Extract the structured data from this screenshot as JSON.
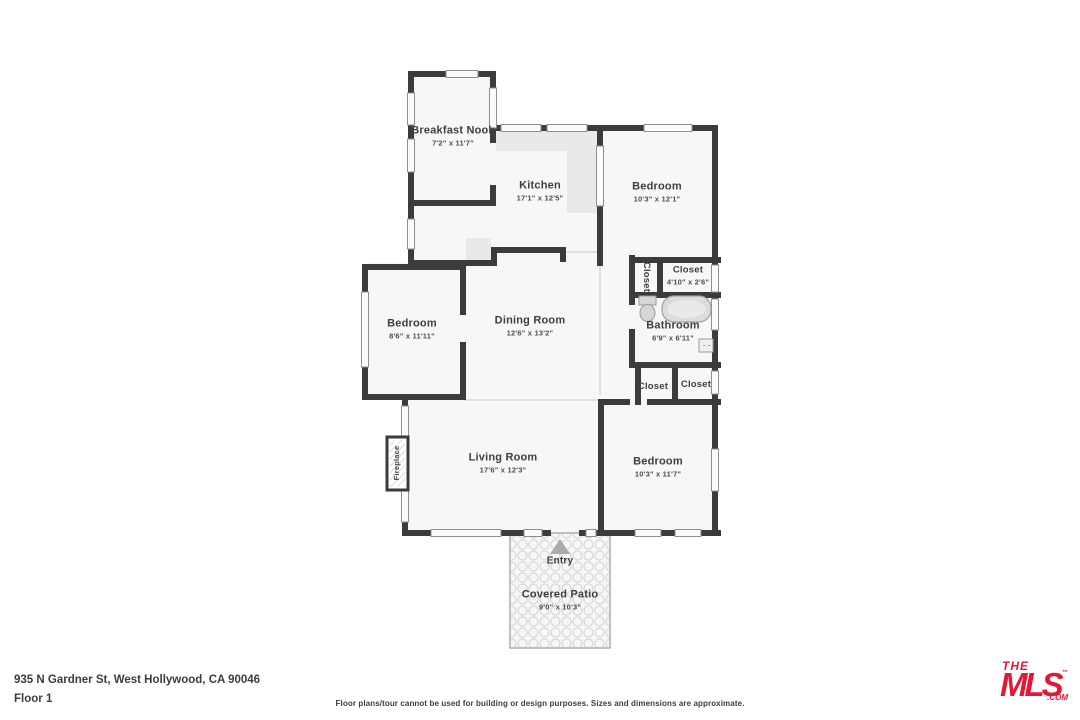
{
  "colors": {
    "wall": "#3b3b3b",
    "floor": "#f7f7f7",
    "counter": "#e9e9e9",
    "fixture": "#d9d9d9",
    "window_frame": "#8f8f8f",
    "patio_tile": "#d8d8d8",
    "logo_red": "#e31837",
    "text": "#3e3e3e"
  },
  "rooms": {
    "breakfast_nook": {
      "name": "Breakfast Nook",
      "dims": "7'2\" x 11'7\""
    },
    "kitchen": {
      "name": "Kitchen",
      "dims": "17'1\" x 12'5\""
    },
    "bedroom_tr": {
      "name": "Bedroom",
      "dims": "10'3\" x 12'1\""
    },
    "closet_hall": {
      "name": "Closet"
    },
    "closet_tr": {
      "name": "Closet",
      "dims": "4'10\" x 2'6\""
    },
    "bathroom": {
      "name": "Bathroom",
      "dims": "6'9\" x 6'11\""
    },
    "dining_room": {
      "name": "Dining Room",
      "dims": "12'6\" x 13'2\""
    },
    "bedroom_left": {
      "name": "Bedroom",
      "dims": "8'6\" x 11'11\""
    },
    "closet_bl": {
      "name": "Closet"
    },
    "closet_br": {
      "name": "Closet"
    },
    "living_room": {
      "name": "Living Room",
      "dims": "17'6\" x 12'3\""
    },
    "bedroom_br": {
      "name": "Bedroom",
      "dims": "10'3\" x 11'7\""
    },
    "covered_patio": {
      "name": "Covered Patio",
      "dims": "9'0\" x 10'3\""
    }
  },
  "labels": {
    "entry": "Entry",
    "fireplace": "Fireplace"
  },
  "footer": {
    "address": "935 N Gardner St, West Hollywood, CA 90046",
    "floor": "Floor 1",
    "disclaimer": "Floor plans/tour cannot be used for building or design purposes. Sizes and dimensions are approximate."
  },
  "logo": {
    "the": "THE",
    "mls": "MLS",
    "tm": "™",
    "com": ".COM"
  }
}
